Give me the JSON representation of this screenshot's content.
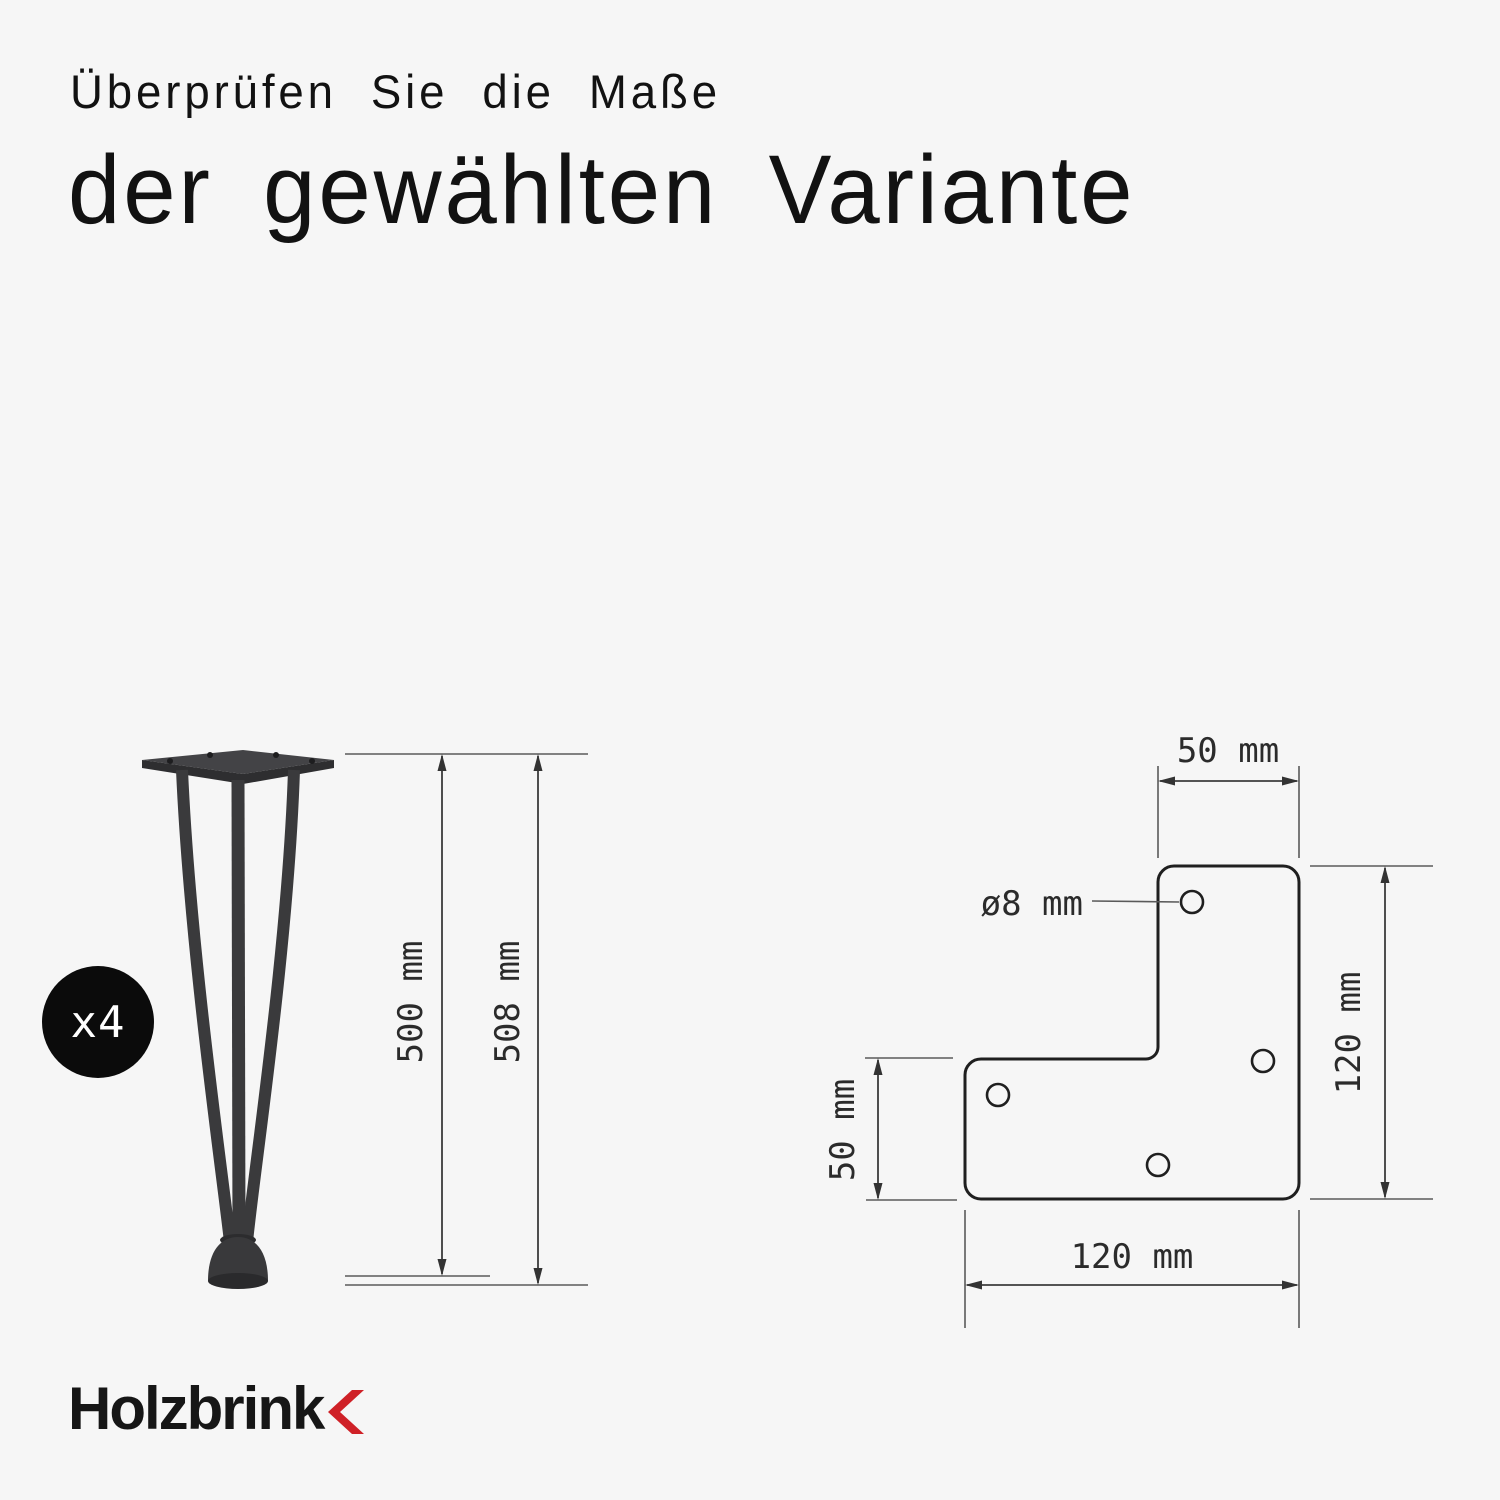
{
  "title": {
    "line1": "Überprüfen Sie die Maße",
    "line2": "der gewählten Variante"
  },
  "badge": {
    "label": "x4"
  },
  "leg_diagram": {
    "height_inner": "500 mm",
    "height_total": "508 mm"
  },
  "plate_diagram": {
    "top_width": "50 mm",
    "hole_diameter": "ø8 mm",
    "right_height": "120 mm",
    "left_height": "50 mm",
    "bottom_width": "120 mm"
  },
  "logo": {
    "text": "Holzbrink"
  },
  "colors": {
    "background": "#f6f6f6",
    "drawing_line": "#3c3c3c",
    "leg_metal": "#3a3a3c",
    "accent_red": "#cf2127",
    "text": "#121212"
  }
}
